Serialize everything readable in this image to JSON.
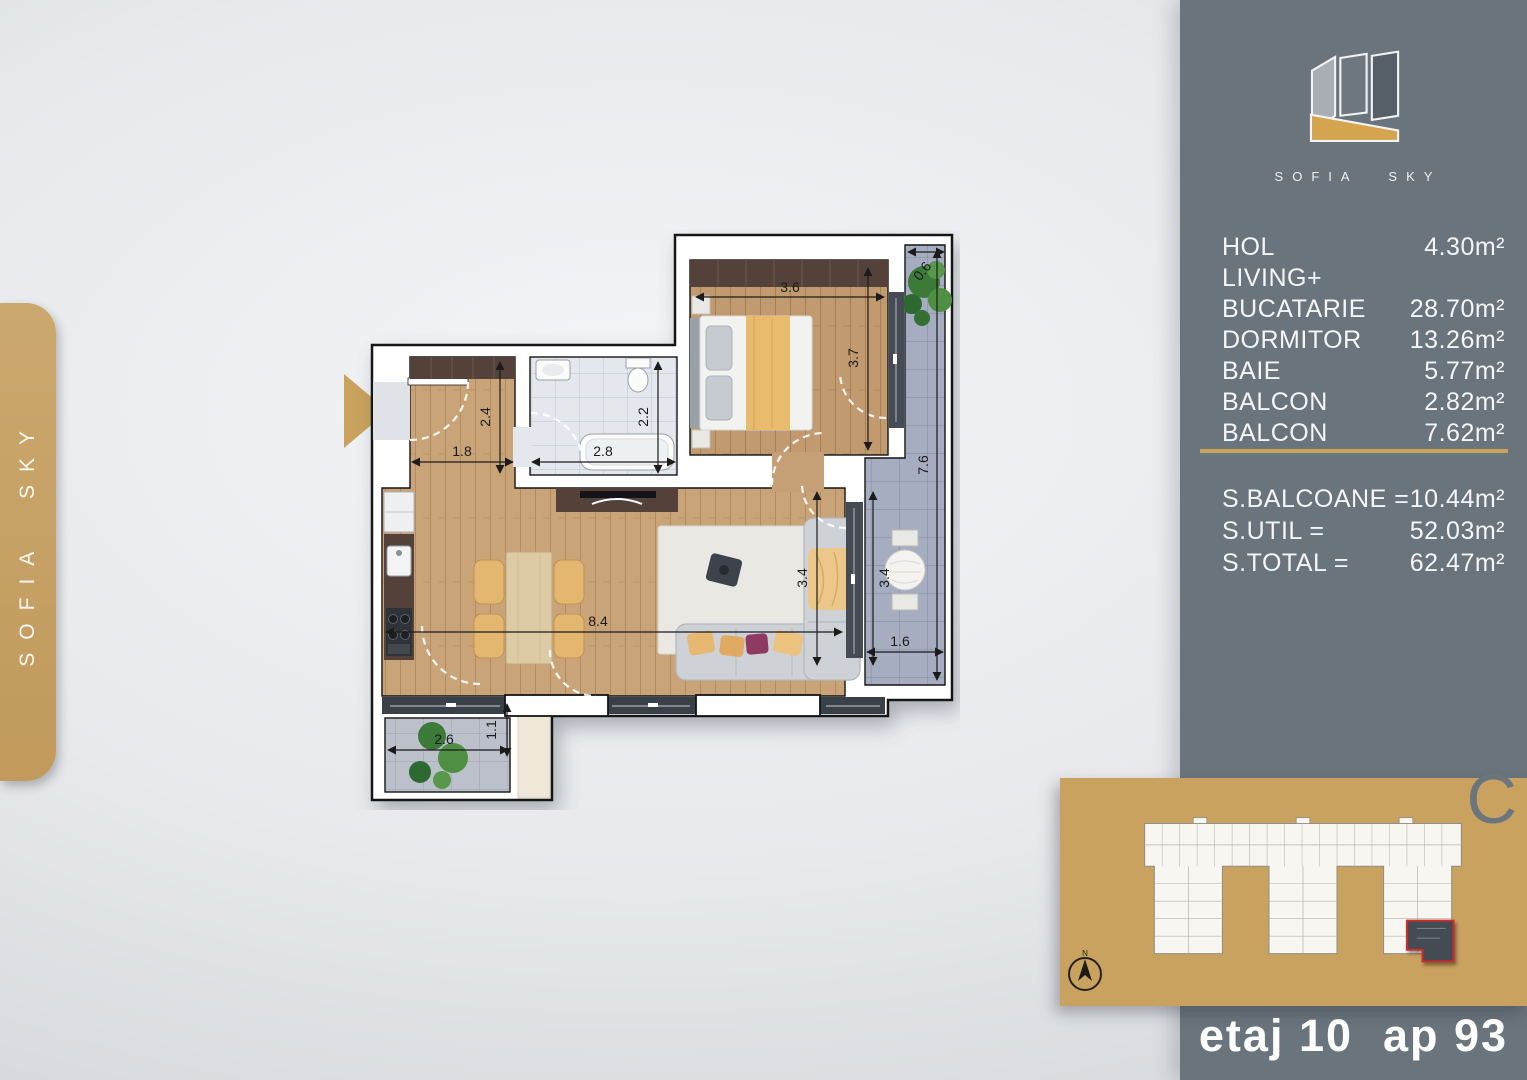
{
  "brand": {
    "logo_text": "SOFIA SKY",
    "side_tab_text": "SOFIA SKY"
  },
  "panel": {
    "rooms": [
      {
        "label": "HOL",
        "area": "4.30m²"
      },
      {
        "label": "LIVING+",
        "area": ""
      },
      {
        "label": "BUCATARIE",
        "area": "28.70m²"
      },
      {
        "label": "DORMITOR",
        "area": "13.26m²"
      },
      {
        "label": "BAIE",
        "area": "5.77m²"
      },
      {
        "label": "BALCON",
        "area": "2.82m²"
      },
      {
        "label": "BALCON",
        "area": "7.62m²"
      }
    ],
    "totals": [
      {
        "label": "S.BALCOANE =",
        "value": "10.44m²"
      },
      {
        "label": "S.UTIL =",
        "value": "52.03m²"
      },
      {
        "label": "S.TOTAL =",
        "value": "62.47m²"
      }
    ],
    "building_letter": "C",
    "compass_label": "N",
    "footer": {
      "floor": "etaj 10",
      "apartment": "ap 93"
    }
  },
  "floor_plan": {
    "dims": {
      "bedroom_w": "3.6",
      "bedroom_h": "3.7",
      "right_balcony_h": "7.6",
      "right_balcony_top_w": "0.6",
      "hall_w": "1.8",
      "hall_h": "2.4",
      "bath_w": "2.8",
      "bath_h": "2.2",
      "living_w": "8.4",
      "living_h": "3.4",
      "right_balcony_bottom_h": "3.4",
      "right_balcony_bottom_w": "1.6",
      "left_balcony_w": "2.6",
      "left_balcony_h": "1.1"
    }
  },
  "colors": {
    "accent_gold": "#c9a25f",
    "sidebar_gray": "#6a747d"
  }
}
